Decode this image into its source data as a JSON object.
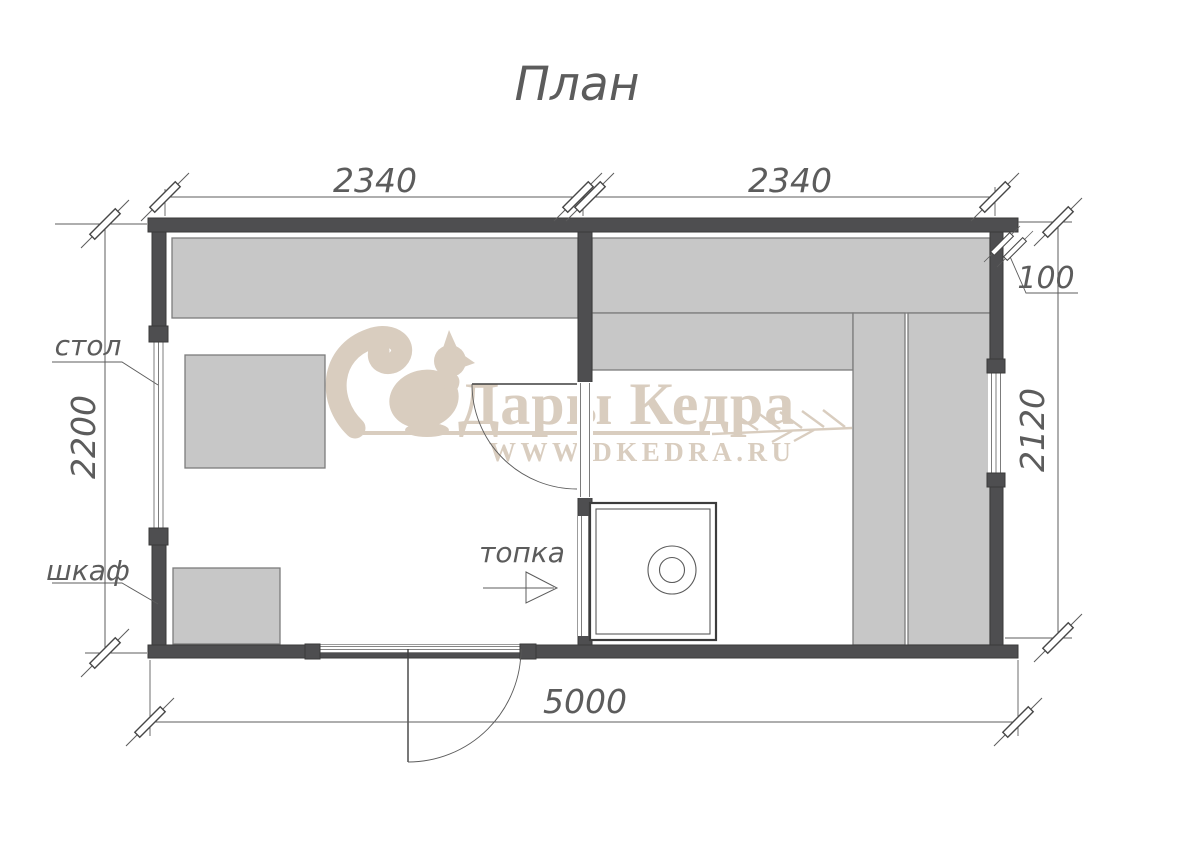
{
  "title": "План",
  "watermark": {
    "brand": "Дары Кедра",
    "site": "WWW.DKEDRA.RU",
    "logo": "squirrel-icon"
  },
  "labels": {
    "table": "стол",
    "cabinet": "шкаф",
    "firebox": "топка"
  },
  "dimensions": {
    "top_left_room_width": "2340",
    "top_right_room_width": "2340",
    "wall_offset": "100",
    "left_depth": "2200",
    "right_depth": "2120",
    "total_width": "5000"
  },
  "colors": {
    "wall": "#4e4e50",
    "wall-edge": "#3a3a3a",
    "furniture": "#c7c7c7",
    "furniture-edge": "#7c7c7c",
    "line": "#5c5c5c",
    "text": "#5c5c5c",
    "watermark": "#d9cdbf",
    "stove-line": "#3c3c3c"
  }
}
